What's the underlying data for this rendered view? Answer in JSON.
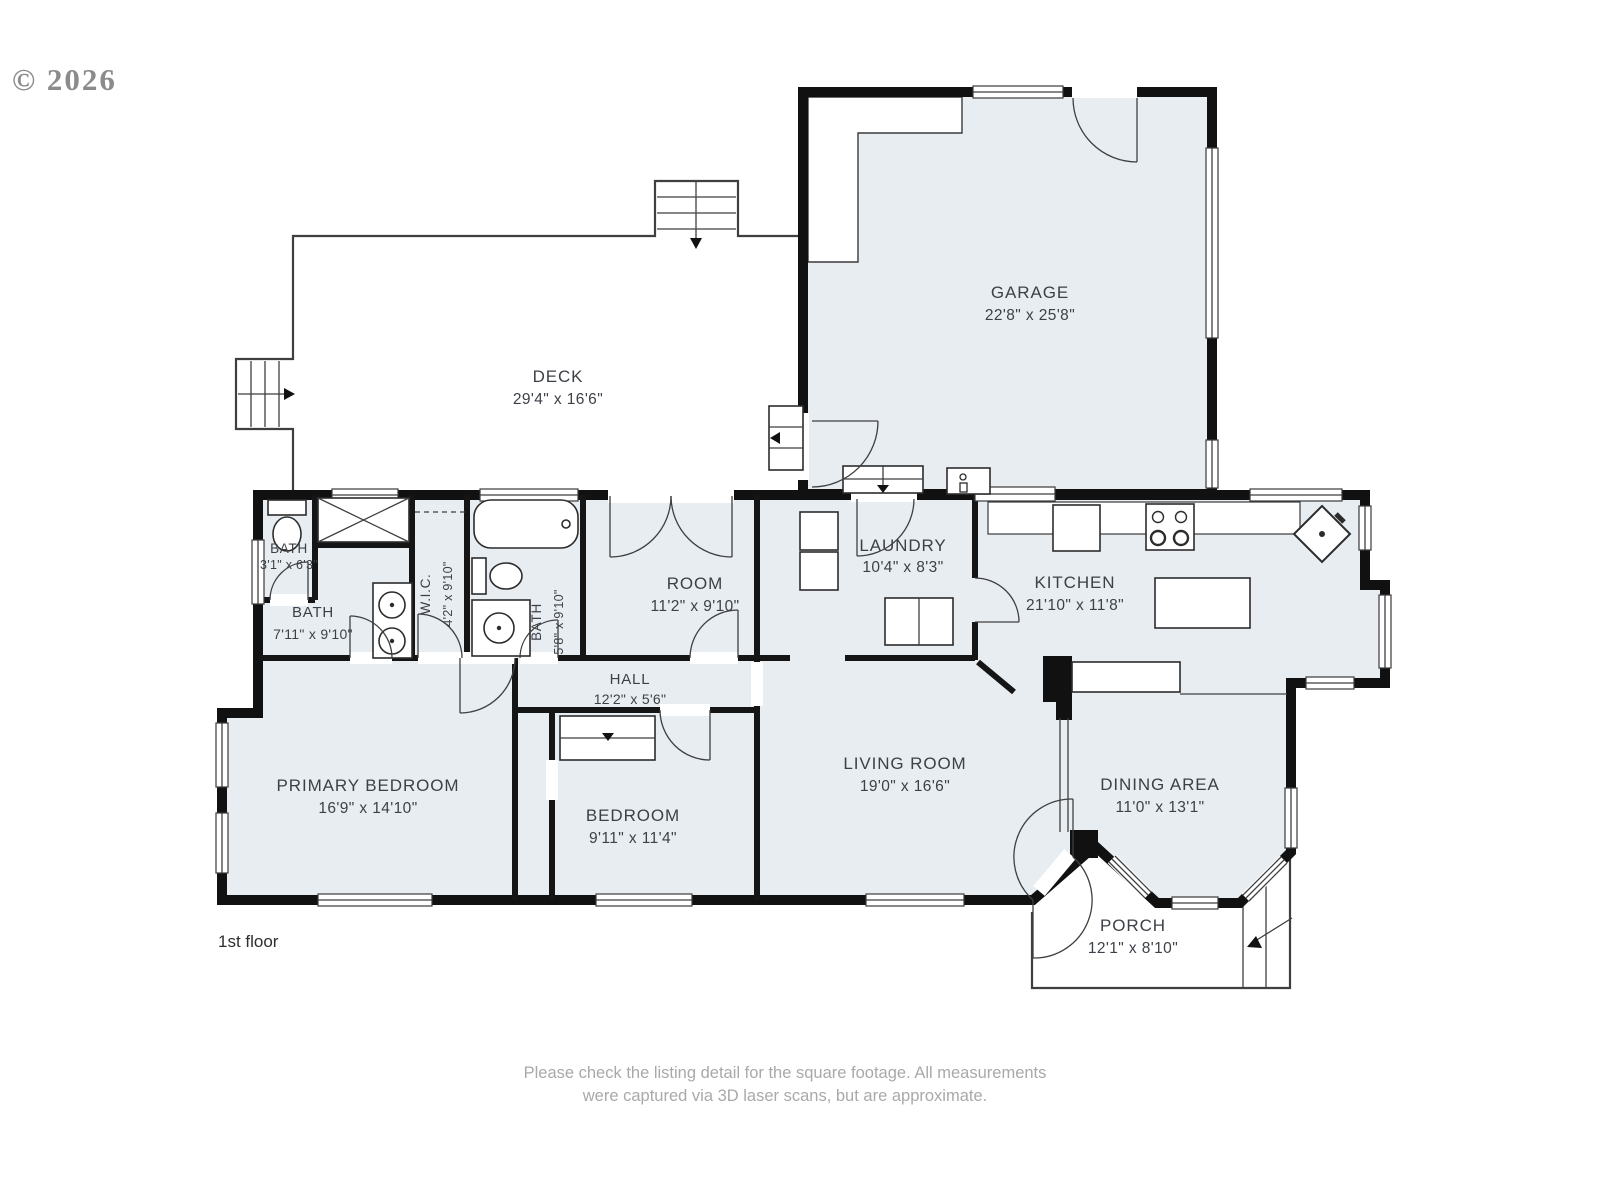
{
  "copyright": "© 2026",
  "floor_label": "1st floor",
  "disclaimer": {
    "line1": "Please check the listing detail for the square footage. All measurements",
    "line2": "were captured via 3D laser scans, but are approximate."
  },
  "colors": {
    "room_fill": "#e8edf2",
    "wall": "#111111",
    "outline": "#3f3f3f",
    "label_text": "#3d4147",
    "muted_text": "#a9a9a9"
  },
  "rooms": [
    {
      "name": "DECK",
      "dims": "29'4\" x 16'6\""
    },
    {
      "name": "GARAGE",
      "dims": "22'8\" x 25'8\""
    },
    {
      "name": "LAUNDRY",
      "dims": "10'4\" x 8'3\""
    },
    {
      "name": "KITCHEN",
      "dims": "21'10\" x 11'8\""
    },
    {
      "name": "ROOM",
      "dims": "11'2\" x 9'10\""
    },
    {
      "name": "BATH",
      "dims": "3'1\" x 6'3\""
    },
    {
      "name": "W.I.C.",
      "dims": "4'2\" x 9'10\""
    },
    {
      "name": "BATH",
      "dims": "5'8\" x 9'10\""
    },
    {
      "name": "BATH",
      "dims": "7'11\" x 9'10\""
    },
    {
      "name": "HALL",
      "dims": "12'2\" x 5'6\""
    },
    {
      "name": "PRIMARY BEDROOM",
      "dims": "16'9\" x 14'10\""
    },
    {
      "name": "BEDROOM",
      "dims": "9'11\" x 11'4\""
    },
    {
      "name": "LIVING ROOM",
      "dims": "19'0\" x 16'6\""
    },
    {
      "name": "DINING AREA",
      "dims": "11'0\" x 13'1\""
    },
    {
      "name": "PORCH",
      "dims": "12'1\" x 8'10\""
    }
  ]
}
